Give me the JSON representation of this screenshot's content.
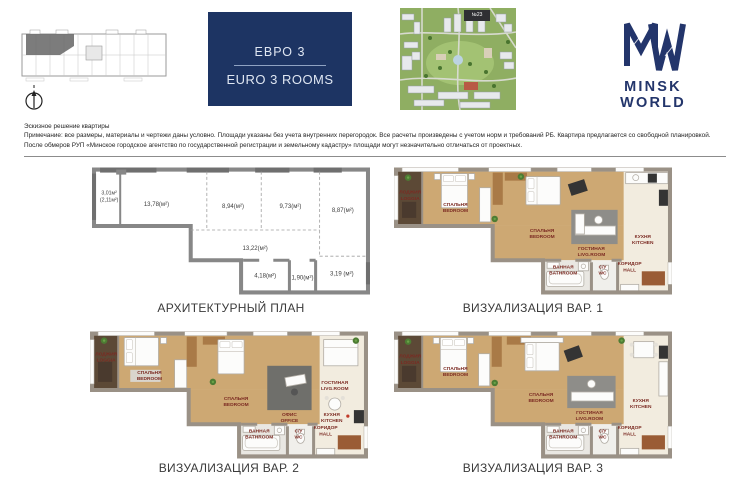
{
  "header": {
    "unit_badge": {
      "ru": "ЕВРО 3",
      "en": "EURO 3 ROOMS"
    },
    "aerial_badge": "№23",
    "logo": {
      "wordmark": "MINSK WORLD"
    }
  },
  "notes": {
    "line1": "Эскизное решение квартиры",
    "line2": "Примечание: все размеры, материалы и чертежи даны условно. Площади указаны без учета внутренних перегородок. Все расчеты произведены с учетом норм и требований РБ. Квартира предлагается со свободной планировкой.",
    "line3": "После обмеров РУП «Минское городское агентство по государственной регистрации и земельному кадастру» площади могут незначительно отличаться от проектных."
  },
  "plans": {
    "architectural": {
      "caption": "АРХИТЕКТУРНЫЙ ПЛАН",
      "areas": {
        "loggia": "3,01м²",
        "loggia2": "(2,11м²)",
        "a1378": "13,78(м²)",
        "a894": "8,94(м²)",
        "a973": "9,73(м²)",
        "a887": "8,87(м²)",
        "a1322": "13,22(м²)",
        "a418": "4,18(м²)",
        "a190": "1,90(м²)",
        "a319": "3,19 (м²)"
      }
    },
    "viz1": {
      "caption": "ВИЗУАЛИЗАЦИЯ ВАР. 1",
      "rooms": {
        "loggia_ru": "ЛОДЖИЯ",
        "loggia_en": "LOGGIA",
        "bedroom1_ru": "СПАЛЬНЯ",
        "bedroom1_en": "BEDROOM",
        "bedroom2_ru": "СПАЛЬНЯ",
        "bedroom2_en": "BEDROOM",
        "living_ru": "ГОСТИНАЯ",
        "living_en": "LIVG.ROOM",
        "kitchen_ru": "КУХНЯ",
        "kitchen_en": "KITCHEN",
        "bath_ru": "ВАННАЯ",
        "bath_en": "BATHROOM",
        "wc_ru": "С/У",
        "wc_en": "WC",
        "hall_ru": "КОРИДОР",
        "hall_en": "HALL"
      }
    },
    "viz2": {
      "caption": "ВИЗУАЛИЗАЦИЯ ВАР. 2",
      "rooms": {
        "loggia_ru": "ЛОДЖИЯ",
        "loggia_en": "LOGGIA",
        "bedroom1_ru": "СПАЛЬНЯ",
        "bedroom1_en": "BEDROOM",
        "bedroom2_ru": "СПАЛЬНЯ",
        "bedroom2_en": "BEDROOM",
        "office_ru": "ОФИС",
        "office_en": "OFFICE",
        "living_ru": "ГОСТИНАЯ",
        "living_en": "LIVG.ROOM",
        "kitchen_ru": "КУХНЯ",
        "kitchen_en": "KITCHEN",
        "bath_ru": "ВАННАЯ",
        "bath_en": "BATHROOM",
        "wc_ru": "С/У",
        "wc_en": "WC",
        "hall_ru": "КОРИДОР",
        "hall_en": "HALL"
      }
    },
    "viz3": {
      "caption": "ВИЗУАЛИЗАЦИЯ ВАР. 3",
      "rooms": {
        "loggia_ru": "ЛОДЖИЯ",
        "loggia_en": "LOGGIA",
        "bedroom1_ru": "СПАЛЬНЯ",
        "bedroom1_en": "BEDROOM",
        "bedroom2_ru": "СПАЛЬНЯ",
        "bedroom2_en": "BEDROOM",
        "living_ru": "ГОСТИНАЯ",
        "living_en": "LIVG.ROOM",
        "kitchen_ru": "КУХНЯ",
        "kitchen_en": "KITCHEN",
        "bath_ru": "ВАННАЯ",
        "bath_en": "BATHROOM",
        "wc_ru": "С/У",
        "wc_en": "WC",
        "hall_ru": "КОРИДОР",
        "hall_en": "HALL"
      }
    }
  },
  "colors": {
    "navy": "#1d3463",
    "label_red": "#7b2a22",
    "wood_floor": "#cda873",
    "wall_viz": "#9a9186",
    "wall_arch": "#878787"
  }
}
